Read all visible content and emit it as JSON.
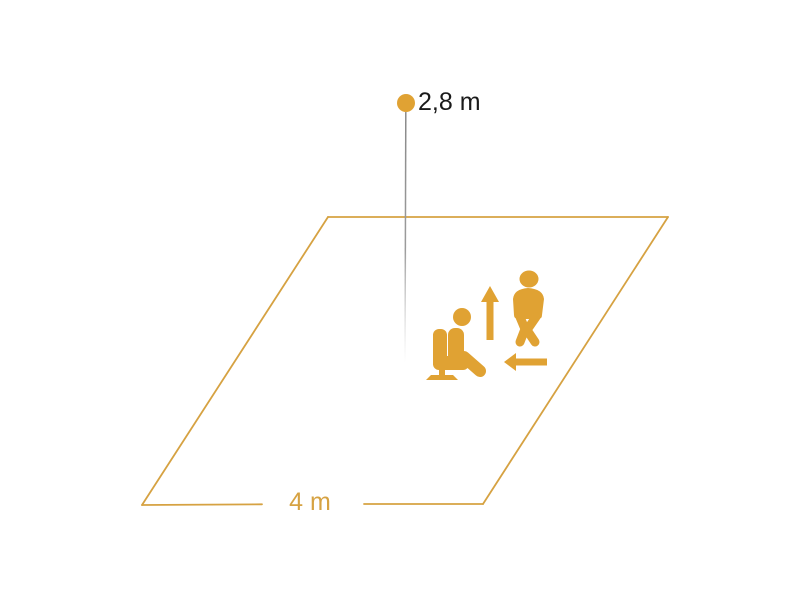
{
  "colors": {
    "accent": "#E0A233",
    "outline_orange": "#D6A242",
    "line_gray": "#8C8C8C",
    "label_dark": "#1A1A1A",
    "background": "#FFFFFF"
  },
  "diagram": {
    "type": "sensor-detection-range-illustration",
    "sensor": {
      "mounting_height_label": "2,8 m",
      "marker": "sensor-dot-icon"
    },
    "detection_area": {
      "shape": "parallelogram",
      "side_length_label": "4 m"
    },
    "icons": {
      "sensor_dot": "sensor-dot-icon",
      "mounting_height_line": "mounting-height-line",
      "seated_person": "seated-person-icon",
      "walking_person": "walking-person-icon",
      "up_arrow": "up-arrow-icon",
      "left_arrow": "left-arrow-icon"
    }
  }
}
